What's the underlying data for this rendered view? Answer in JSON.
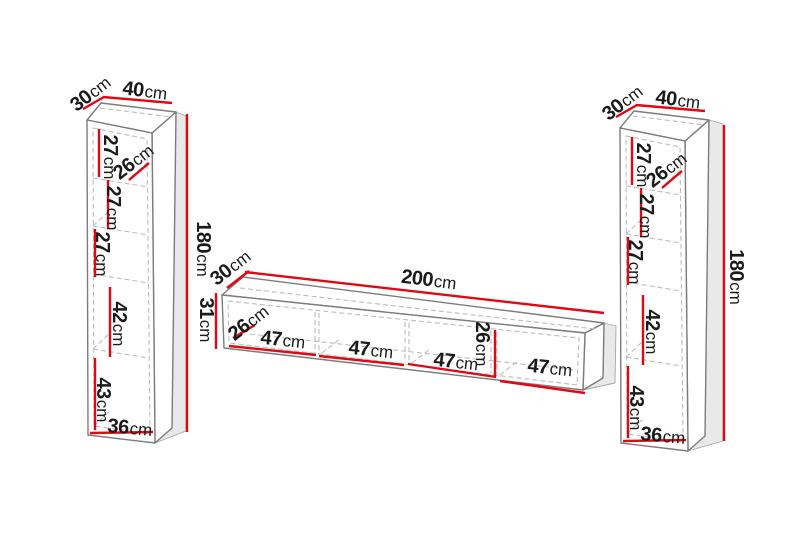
{
  "colors": {
    "dimension": "#e30613",
    "outline": "#7c7c7c",
    "dashed": "#bcbcbc",
    "shadow_fill": "#e9e9e9",
    "face_fill": "#ffffff",
    "label_text": "#1b1b1b",
    "background": "#ffffff"
  },
  "diagram": {
    "unit": "cm",
    "left_cabinet": {
      "depth": {
        "v": "30",
        "u": "cm"
      },
      "width": {
        "v": "40",
        "u": "cm"
      },
      "height": {
        "v": "180",
        "u": "cm"
      },
      "shelf_heights": [
        {
          "v": "27",
          "u": "cm"
        },
        {
          "v": "27",
          "u": "cm"
        },
        {
          "v": "27",
          "u": "cm"
        },
        {
          "v": "42",
          "u": "cm"
        },
        {
          "v": "43",
          "u": "cm"
        }
      ],
      "inner_depth": {
        "v": "26",
        "u": "cm"
      },
      "inner_width": {
        "v": "36",
        "u": "cm"
      }
    },
    "tv_stand": {
      "depth": {
        "v": "30",
        "u": "cm"
      },
      "width": {
        "v": "200",
        "u": "cm"
      },
      "height": {
        "v": "31",
        "u": "cm"
      },
      "inner_depth": {
        "v": "26",
        "u": "cm"
      },
      "inner_height": {
        "v": "26",
        "u": "cm"
      },
      "compartment_widths": [
        {
          "v": "47",
          "u": "cm"
        },
        {
          "v": "47",
          "u": "cm"
        },
        {
          "v": "47",
          "u": "cm"
        },
        {
          "v": "47",
          "u": "cm"
        }
      ]
    },
    "right_cabinet": {
      "depth": {
        "v": "30",
        "u": "cm"
      },
      "width": {
        "v": "40",
        "u": "cm"
      },
      "height": {
        "v": "180",
        "u": "cm"
      },
      "shelf_heights": [
        {
          "v": "27",
          "u": "cm"
        },
        {
          "v": "27",
          "u": "cm"
        },
        {
          "v": "27",
          "u": "cm"
        },
        {
          "v": "42",
          "u": "cm"
        },
        {
          "v": "43",
          "u": "cm"
        }
      ],
      "inner_depth": {
        "v": "26",
        "u": "cm"
      },
      "inner_width": {
        "v": "36",
        "u": "cm"
      }
    }
  }
}
